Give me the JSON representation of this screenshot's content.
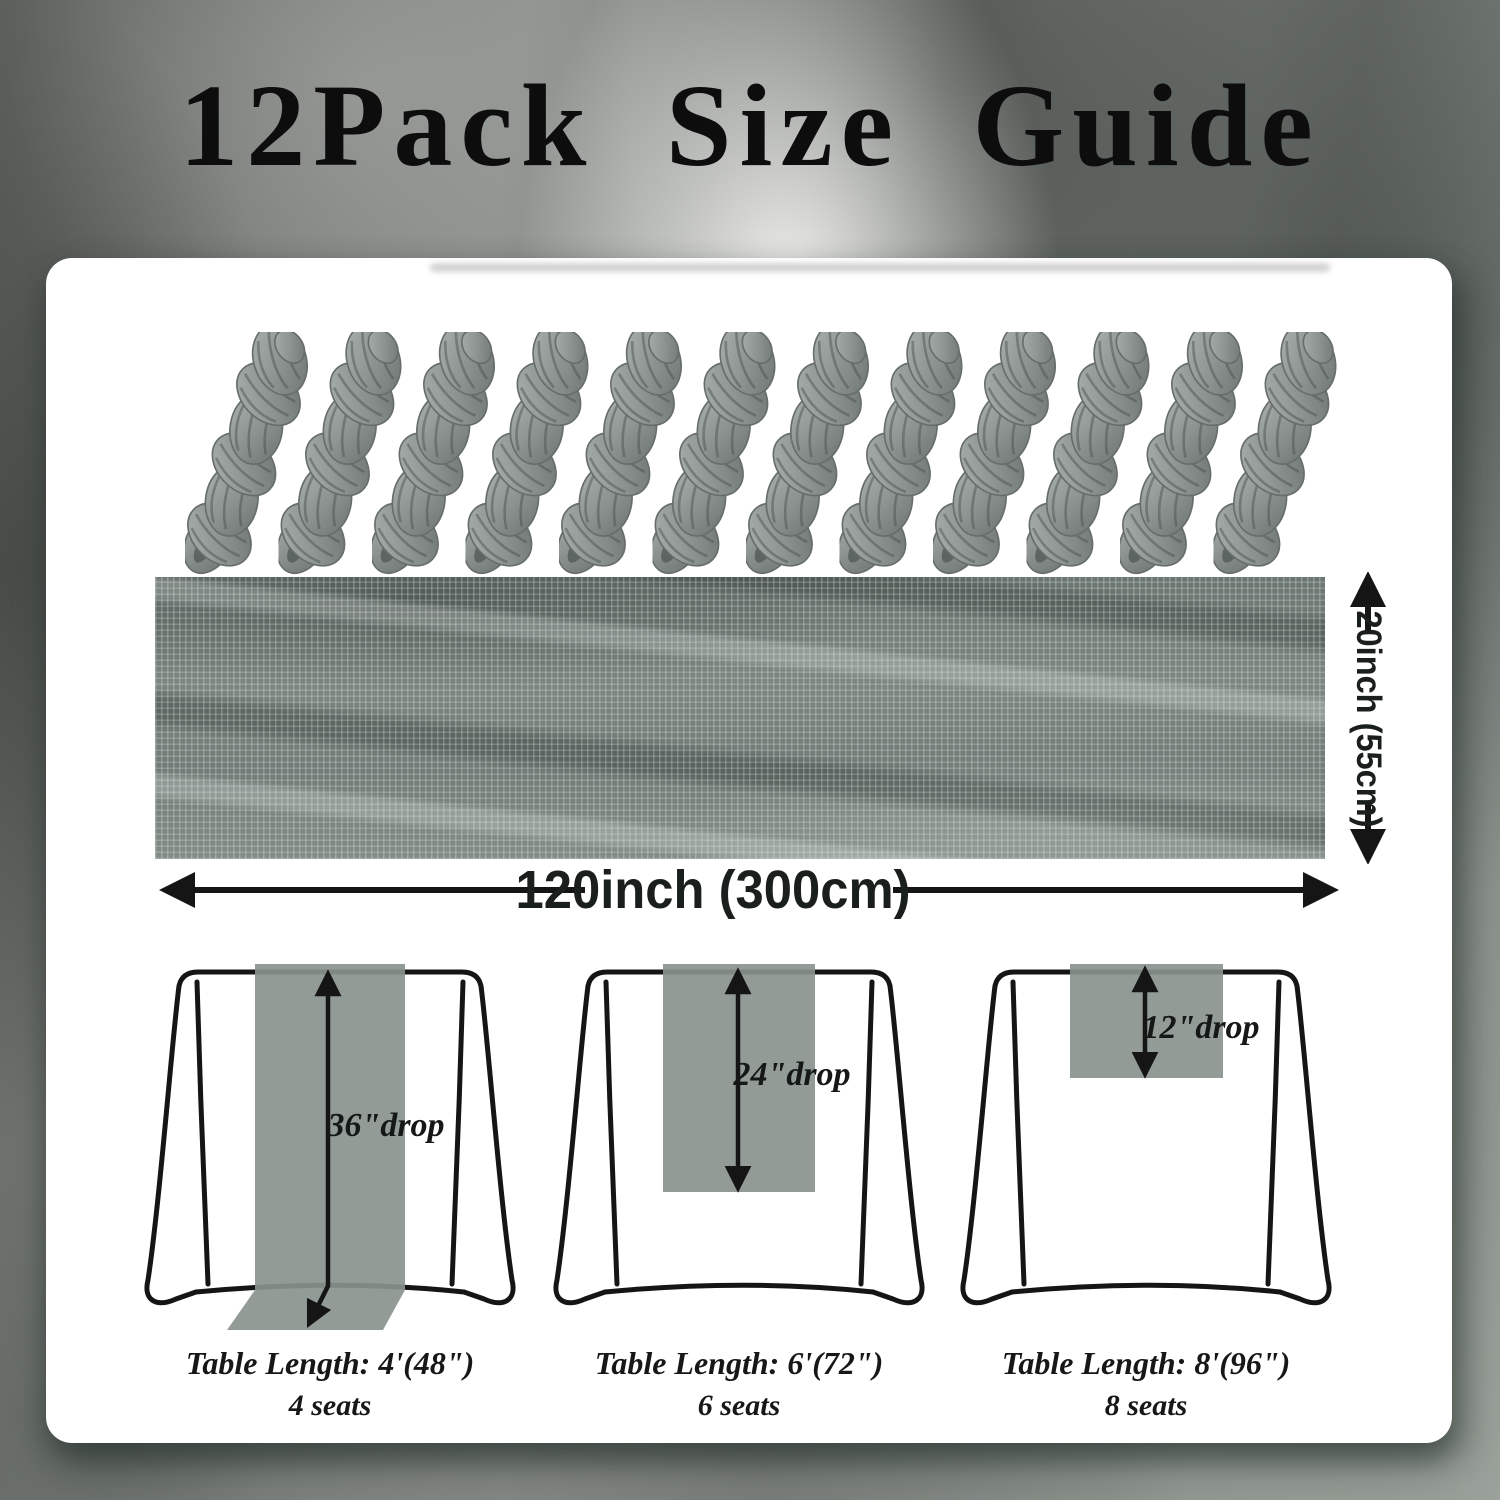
{
  "title": "12Pack Size Guide",
  "bundles": {
    "count": 12
  },
  "dimensions": {
    "width_label": "20inch (55cm)",
    "length_label": "120inch (300cm)"
  },
  "tables": [
    {
      "drop": "36\"drop",
      "length": "Table Length: 4'(48\")",
      "seats": "4 seats"
    },
    {
      "drop": "24\"drop",
      "length": "Table Length: 6'(72\")",
      "seats": "6 seats"
    },
    {
      "drop": "12\"drop",
      "length": "Table Length: 8'(96\")",
      "seats": "8 seats"
    }
  ],
  "colors": {
    "title_text": "#0d0d0d",
    "panel_bg": "#ffffff",
    "runner_overlay": "#8a938d",
    "fabric_swatch": "#76817c",
    "bundle_gray": "#8d9492",
    "outline_black": "#151515"
  }
}
